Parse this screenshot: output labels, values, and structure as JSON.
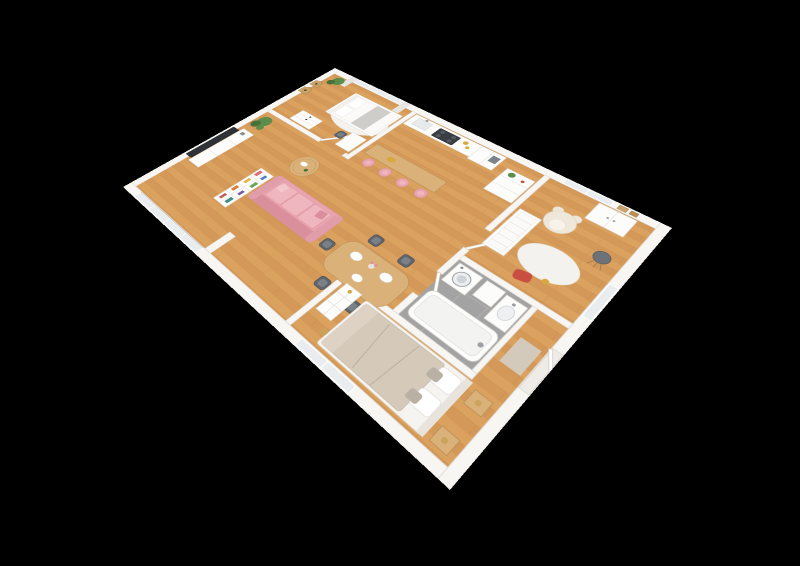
{
  "scene": {
    "description": "3D isometric cutaway floor plan render of a furnished one-bedroom-plus-nursery apartment, viewed from above at an angle on a plain black background",
    "background_color": "#000000",
    "floor_material": "light oak plank",
    "wall_color": "white"
  },
  "palette": {
    "bg": "#000000",
    "wall": "#f7f6f3",
    "wallLine": "#dcd8d2",
    "white": "#fcfcfb",
    "whiteLine": "#e0ddd6",
    "wood1": "#dba25f",
    "wood2": "#d49959",
    "plank": "#bd8242",
    "grayFloor": "#a3a3a3",
    "glass": "#e9edef",
    "curtain": "#e7e5e1",
    "pink": "#e8a4af",
    "pinkDark": "#d98f9c",
    "pinkLight": "#efb6bf",
    "oak": "#d9b179",
    "oakDark": "#bb9258",
    "green": "#5d8c4b",
    "greenDark": "#47703a",
    "chair": "#60656c",
    "chairSeat": "#7a8088",
    "steel": "#9aa0a6",
    "dark": "#3a3d42",
    "tv": "#2e3135",
    "duvet": "#d5c9ba",
    "duvetFold": "#ddd2c4",
    "teddy": "#efe8da",
    "rug": "#f4f2ee",
    "amber": "#d8a73e",
    "red": "#c94f43",
    "gold": "#c9a45a"
  },
  "rooms": [
    {
      "name": "bedroom",
      "furniture": [
        "double-bed",
        "gray-throw",
        "dresser",
        "desk-and-chair",
        "potted-plant",
        "curtained-window",
        "house-shaped-wall-shelves",
        "white-rug"
      ]
    },
    {
      "name": "living-room",
      "furniture": [
        "wall-mounted-tv",
        "media-sideboard",
        "tall-potted-plant",
        "pink-sofa",
        "round-coffee-table",
        "bookshelf-divider",
        "sliding-glass-balcony-door"
      ]
    },
    {
      "name": "dining-area",
      "furniture": [
        "oak-dining-table",
        "five-gray-chairs",
        "plates",
        "flower-vase"
      ]
    },
    {
      "name": "kitchen",
      "furniture": [
        "counter-with-sink",
        "dark-cooktop",
        "tall-white-cabinets",
        "oak-breakfast-bar",
        "four-pink-bar-stools",
        "fruit-bowl",
        "jars"
      ]
    },
    {
      "name": "hallway",
      "furniture": [
        "white-drawer-cabinet",
        "plant-on-cabinet"
      ]
    },
    {
      "name": "nursery",
      "furniture": [
        "teddy-bear",
        "white-crib",
        "wardrobe",
        "round-white-rug",
        "gray-floor-lamp",
        "red-cushion",
        "window",
        "picture-frames"
      ]
    },
    {
      "name": "bathroom",
      "furniture": [
        "washing-machine",
        "boiler-cabinet",
        "sink-vanity",
        "bathtub",
        "gray-tile-floor"
      ]
    },
    {
      "name": "master-bedroom",
      "furniture": [
        "king-bed",
        "pillows",
        "white-dresser",
        "oak-nightstands",
        "brass-floor-lamp",
        "window"
      ]
    },
    {
      "name": "entry-hall",
      "furniture": [
        "entrance-door",
        "doormat"
      ]
    }
  ]
}
